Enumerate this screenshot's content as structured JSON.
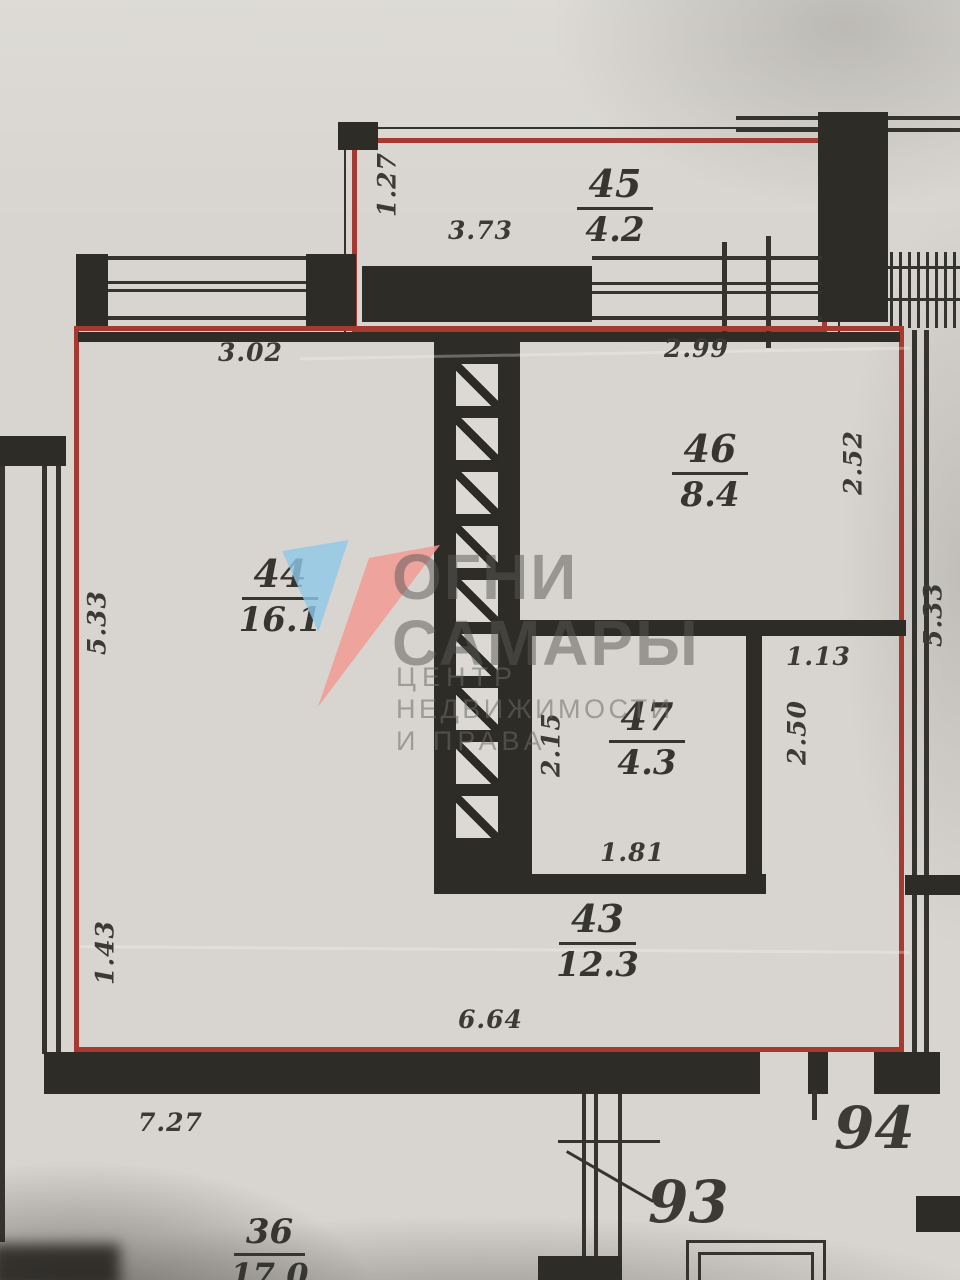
{
  "plan": {
    "watermark": {
      "title_line1": "ОГНИ",
      "title_line2": "САМАРЫ",
      "subtitle_line1": "ЦЕНТР",
      "subtitle_line2": "НЕДВИЖИМОСТИ",
      "subtitle_line3": "И ПРАВА"
    },
    "rooms": {
      "r45": {
        "number": "45",
        "area": "4.2"
      },
      "r44": {
        "number": "44",
        "area": "16.1"
      },
      "r46": {
        "number": "46",
        "area": "8.4"
      },
      "r47": {
        "number": "47",
        "area": "4.3"
      },
      "r43": {
        "number": "43",
        "area": "12.3"
      },
      "r36": {
        "number": "36",
        "area": "17.0"
      }
    },
    "units": {
      "u94": "94",
      "u93": "93"
    },
    "dims": {
      "balcony_width": "3.73",
      "balcony_depth": "1.27",
      "room44_top": "3.02",
      "room44_left": "5.33",
      "room46_top": "2.99",
      "room46_right": "2.52",
      "corridor_top": "1.13",
      "corridor_right": "2.50",
      "room47_left": "2.15",
      "room47_bottom": "1.81",
      "room43_left": "1.43",
      "room43_bottom": "6.64",
      "outer_right": "5.33",
      "outer_bottom": "7.27"
    },
    "colors": {
      "boundary_red": "#a73a30",
      "wall_black": "#2e2c27",
      "paper": "#d8d5d0",
      "logo_blue": "#8fc8e8",
      "logo_salmon": "#f29a93",
      "watermark_gray": "#6c6c68"
    }
  }
}
